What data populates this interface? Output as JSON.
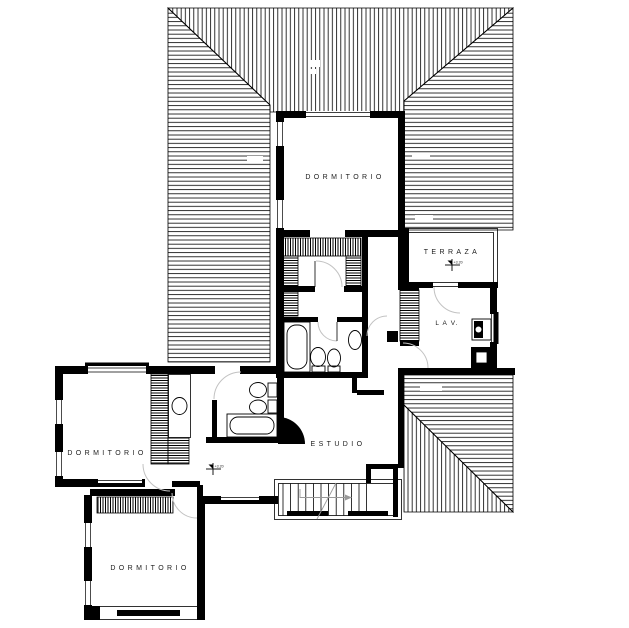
{
  "drawing": {
    "type": "architectural floor plan",
    "rooms": [
      {
        "id": "dormitorio-top",
        "label": "DORMITORIO"
      },
      {
        "id": "terraza",
        "label": "TERRAZA"
      },
      {
        "id": "lavadero",
        "label": "L A V."
      },
      {
        "id": "dormitorio-left",
        "label": "DORMITORIO"
      },
      {
        "id": "estudio",
        "label": "ESTUDIO"
      },
      {
        "id": "dormitorio-bottom",
        "label": "DORMITORIO"
      }
    ],
    "level_markers": [
      {
        "id": "terraza-level",
        "label": "+3.20"
      },
      {
        "id": "hall-level",
        "label": "+3.20"
      }
    ],
    "colors": {
      "ink": "#000000",
      "paper": "#ffffff",
      "door_arc": "#c2c2c2"
    }
  }
}
